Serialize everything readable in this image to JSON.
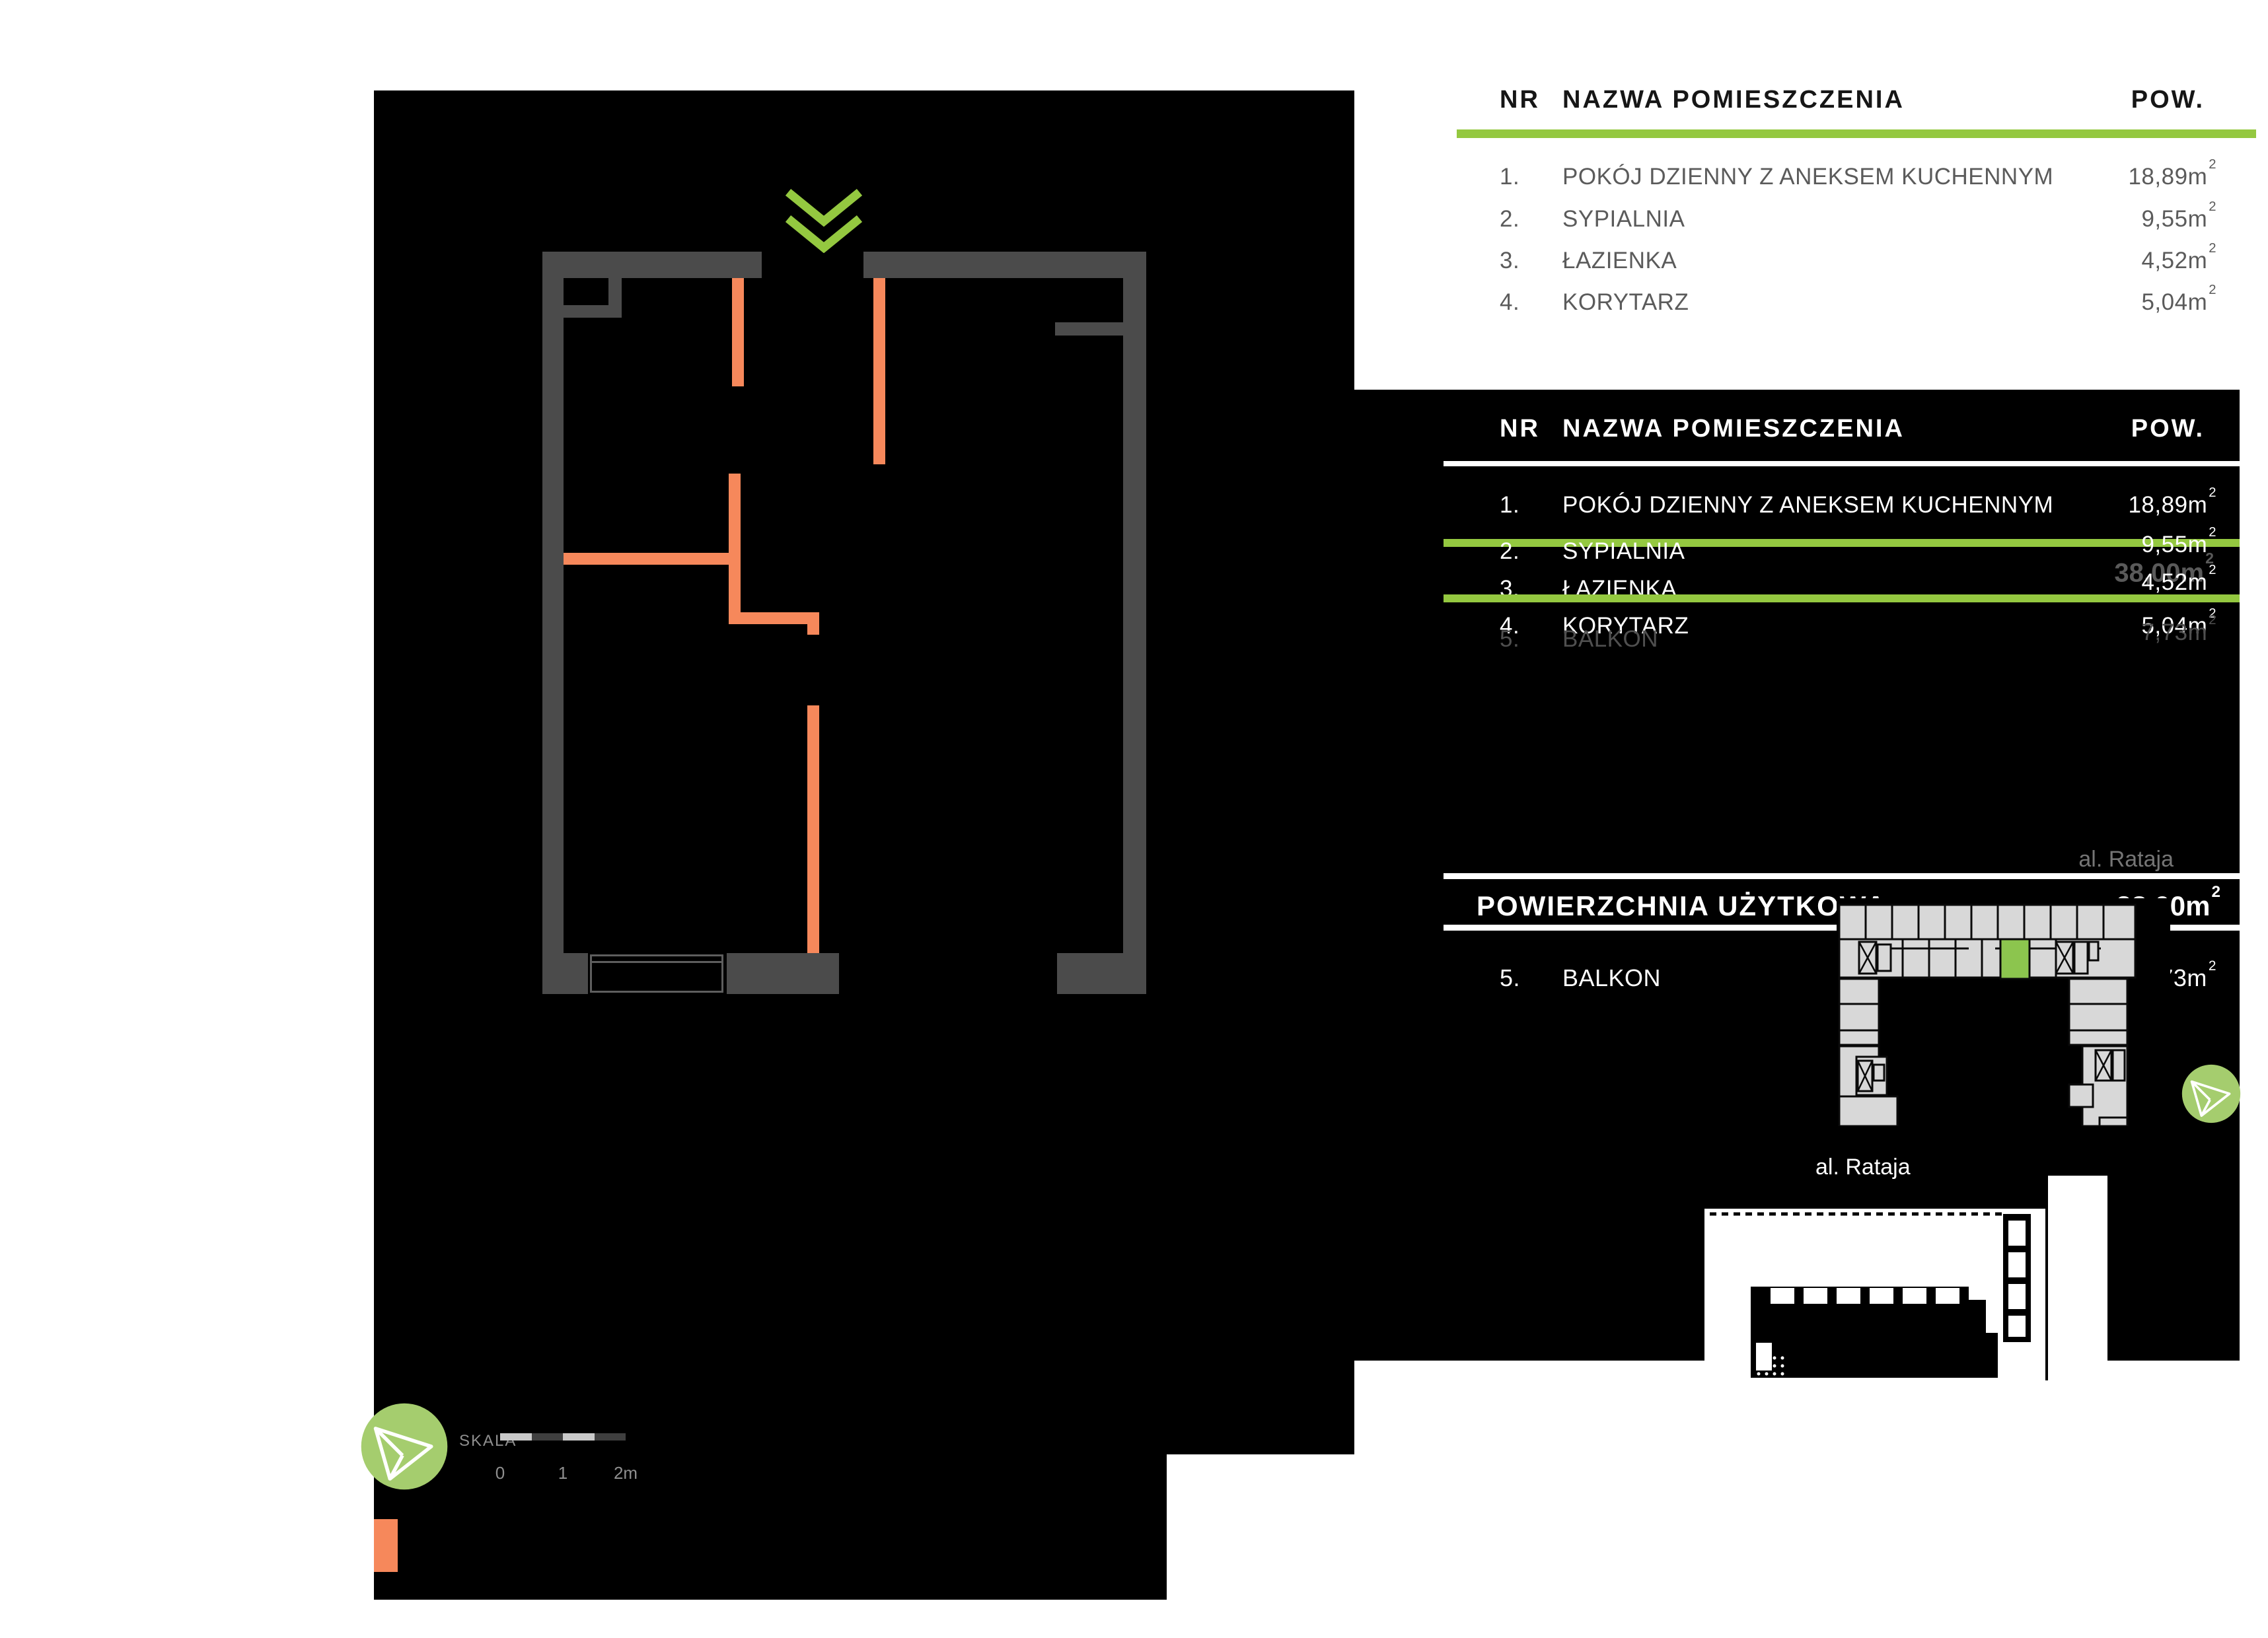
{
  "colors": {
    "accent_green": "#94c840",
    "soft_green": "#a5cd6e",
    "unit_green": "#8cc54e",
    "orange": "#f6885b",
    "wall_gray": "#4b4b4b",
    "panel_black": "#000000"
  },
  "rooms_table": {
    "col_nr": "NR",
    "col_name": "NAZWA POMIESZCZENIA",
    "col_area": "POW.",
    "rows": [
      {
        "nr": "1.",
        "name": "POKÓJ DZIENNY Z ANEKSEM KUCHENNYM",
        "area": "18,89",
        "unit": "m",
        "sup": "2"
      },
      {
        "nr": "2.",
        "name": "SYPIALNIA",
        "area": "9,55",
        "unit": "m",
        "sup": "2"
      },
      {
        "nr": "3.",
        "name": "ŁAZIENKA",
        "area": "4,52",
        "unit": "m",
        "sup": "2"
      },
      {
        "nr": "4.",
        "name": "KORYTARZ",
        "area": "5,04",
        "unit": "m",
        "sup": "2"
      }
    ]
  },
  "overlay_table": {
    "col_nr": "NR",
    "col_name": "NAZWA POMIESZCZENIA",
    "col_area": "POW.",
    "rows": [
      {
        "nr": "1.",
        "name": "POKÓJ DZIENNY Z ANEKSEM KUCHENNYM",
        "area": "18,89",
        "unit": "m",
        "sup": "2"
      },
      {
        "nr": "2.",
        "name": "SYPIALNIA",
        "area": "9,55",
        "unit": "m",
        "sup": "2"
      },
      {
        "nr": "3.",
        "name": "ŁAZIENKA",
        "area": "4,52",
        "unit": "m",
        "sup": "2"
      },
      {
        "nr": "4.",
        "name": "KORYTARZ",
        "area": "5,04",
        "unit": "m",
        "sup": "2"
      }
    ],
    "ghost_total": {
      "area": "38,00",
      "unit": "m",
      "sup": "2"
    },
    "ghost_row": {
      "nr": "5.",
      "name": "BALKON",
      "area": "7,73",
      "unit": "m",
      "sup": "2"
    }
  },
  "summary": {
    "label": "POWIERZCHNIA UŻYTKOWA",
    "total": {
      "area": "38,00",
      "unit": "m",
      "sup": "2"
    },
    "balcony": {
      "nr": "5.",
      "name": "BALKON",
      "area": "7,73",
      "unit": "m",
      "sup": "2"
    }
  },
  "map_labels": {
    "street_top": "al. Rataja",
    "street_bottom": "al. Rataja"
  },
  "scale_bar": {
    "label": "SKALA",
    "ticks": [
      "0",
      "1",
      "2m"
    ]
  }
}
